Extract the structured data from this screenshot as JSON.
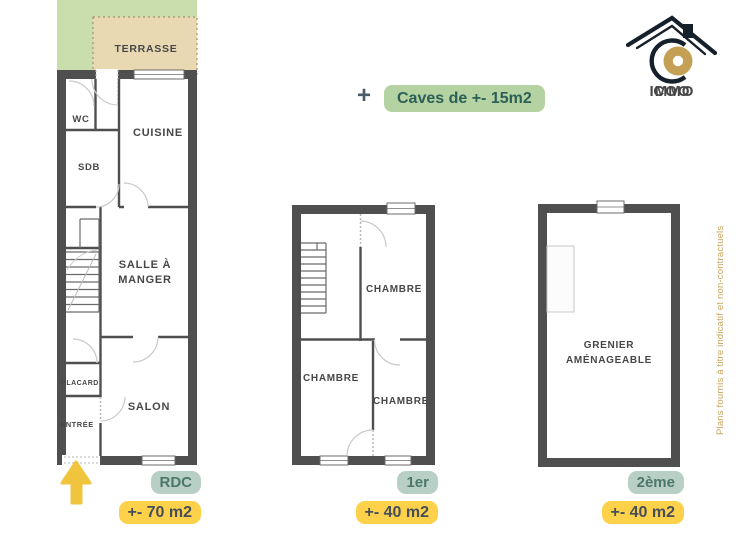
{
  "brand": {
    "primary": "COO",
    "secondary": "IMMO"
  },
  "disclaimer": "Plans fournis à titre indicatif et non-contractuels",
  "annex": {
    "icon": "+",
    "label": "Caves de +- 15m2"
  },
  "floors": {
    "rdc": {
      "badge": "RDC",
      "area": "+- 70 m2",
      "rooms": {
        "terrasse": "TERRASSE",
        "wc": "WC",
        "cuisine": "CUISINE",
        "sdb": "SDB",
        "salle_line1": "SALLE À",
        "salle_line2": "MANGER",
        "placard": "PLACARD",
        "entree": "ENTRÉE",
        "salon": "SALON"
      }
    },
    "premier": {
      "badge": "1er",
      "area": "+- 40 m2",
      "rooms": {
        "chambre_top": "CHAMBRE",
        "chambre_left": "CHAMBRE",
        "chambre_right": "CHAMBRE"
      }
    },
    "deuxieme": {
      "badge": "2ème",
      "area": "+- 40 m2",
      "rooms": {
        "grenier_line1": "GRENIER",
        "grenier_line2": "AMÉNAGEABLE"
      }
    }
  },
  "colors": {
    "wall": "#4f4f4f",
    "garden_green": "#c9ddad",
    "terrace_beige": "#e9d9b3",
    "badge_green_bg": "#b7cfc4",
    "badge_green_text": "#4d776b",
    "badge_yellow_bg": "#fdd14a",
    "badge_yellow_text": "#454e59",
    "caves_pill_bg": "#b4d2a2",
    "caves_pill_text": "#2c5f55",
    "arrow_yellow": "#f0c43c",
    "brand_gold": "#c3a054",
    "brand_dark": "#15202b",
    "disclaimer_gold": "#c9a35b"
  }
}
